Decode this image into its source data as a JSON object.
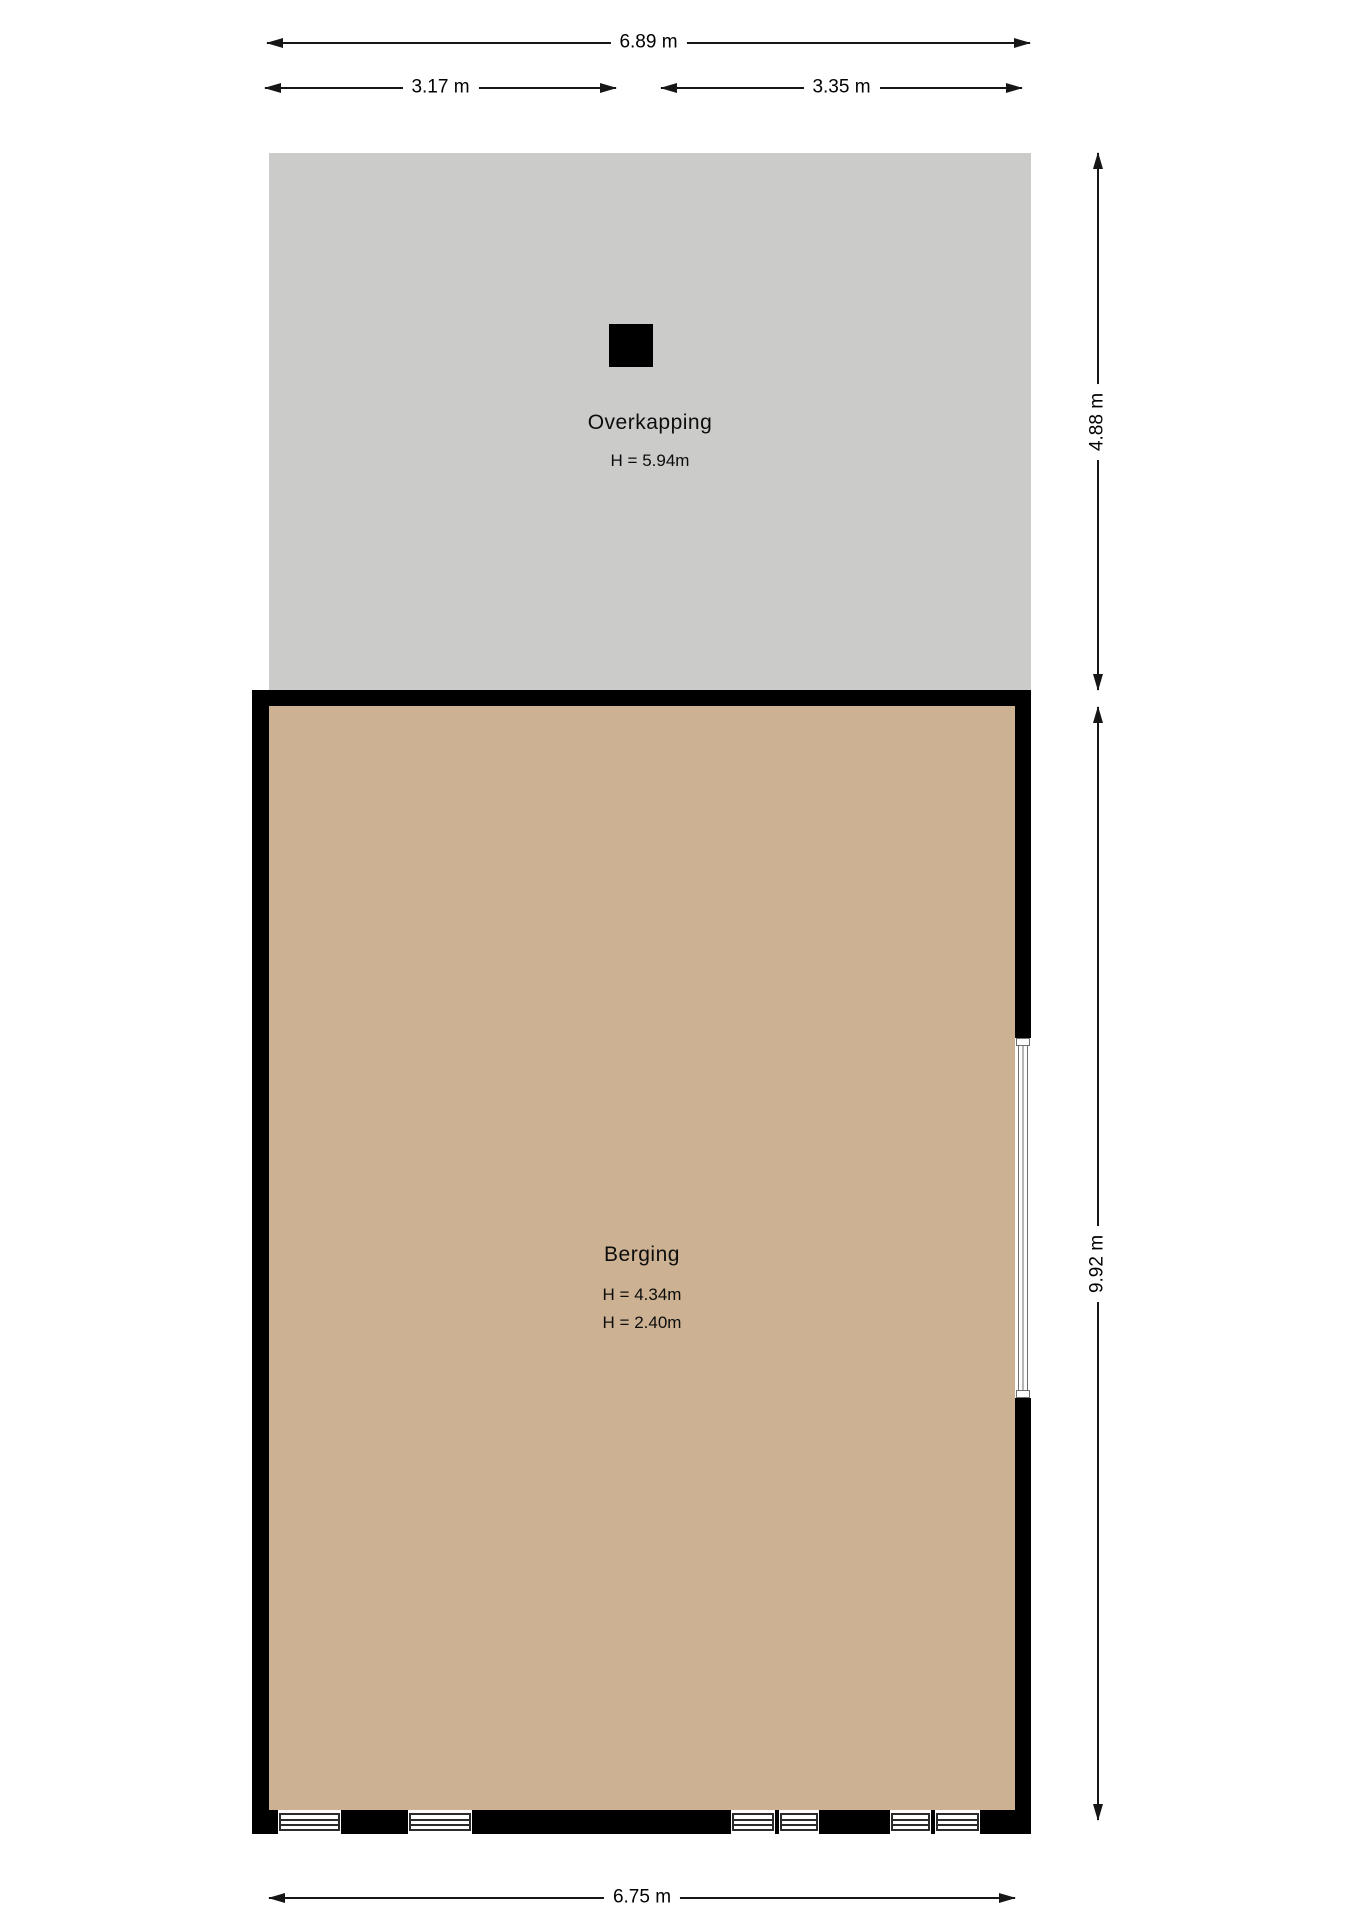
{
  "rooms": {
    "overkapping": {
      "name": "Overkapping",
      "height_label": "H = 5.94m",
      "fill": "#cbcbca"
    },
    "berging": {
      "name": "Berging",
      "height_label_1": "H = 4.34m",
      "height_label_2": "H = 2.40m",
      "fill": "#ccb292"
    }
  },
  "dimensions": {
    "top_total": {
      "label": "6.89 m"
    },
    "top_left": {
      "label": "3.17 m"
    },
    "top_right": {
      "label": "3.35 m"
    },
    "right_overkapping": {
      "label": "4.88 m"
    },
    "right_berging": {
      "label": "9.92 m"
    },
    "bottom": {
      "label": "6.75 m"
    }
  },
  "colors": {
    "background": "#ffffff",
    "wall": "#000000",
    "overkapping_fill": "#cbcbca",
    "berging_fill": "#ccb292",
    "dimension_line": "#161616"
  }
}
